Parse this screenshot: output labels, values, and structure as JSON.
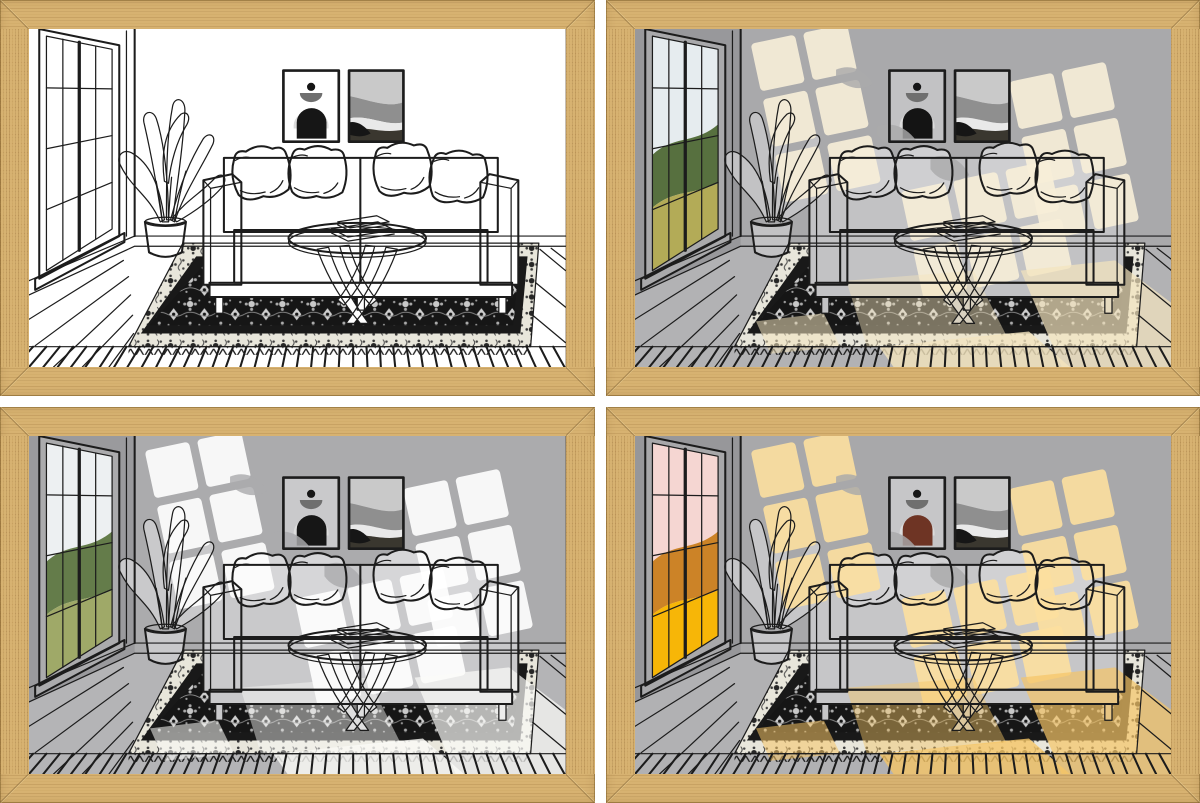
{
  "page": {
    "background": "#ffffff",
    "grid_gap_px": 11,
    "frame_border_px": 29
  },
  "frame_style": {
    "wood_base": "#d7b271",
    "wood_grain": "#926830",
    "wood_highlight": "#f0daa0",
    "wood_edge": "#80602c",
    "miter_corners": true
  },
  "scene": {
    "line_color": "#1c1c1c",
    "elements": [
      "window",
      "window-view",
      "potted-plant",
      "sofa",
      "throw-pillows",
      "wall-art-arch",
      "wall-art-waves",
      "coffee-table",
      "books",
      "oriental-rug",
      "rug-fringe",
      "wood-plank-floor",
      "baseboard",
      "sunlight-patches",
      "leaf-shadows"
    ],
    "art_arch": {
      "dot": "#161616",
      "half_disc": "#6f6f6f",
      "light_arch": "#dcdcdc"
    },
    "art_waves": {
      "colors": [
        "#c9c9c9",
        "#8f8f8f",
        "#e9e9e9",
        "#3a372f",
        "#161616"
      ]
    },
    "rug": {
      "field": "#161616",
      "motif_light": "#c9c9c9",
      "guard_band": "#191919",
      "border_bg": "#e8e6db",
      "border_motif": "#262626"
    }
  },
  "frames": [
    {
      "id": "top-left",
      "variant": "line-art-light-off",
      "lightOn": 0,
      "colors": {
        "wall": "#ffffff",
        "wallSide": "#ffffff",
        "floor": "#ffffff",
        "obj": "#ffffff",
        "pillow": "#ffffff",
        "artArch": "#161616",
        "viewSky": "#ffffff",
        "viewTrees": "#ffffff",
        "viewGround": "#ffffff",
        "light": "#ffffff",
        "pool": "#ffffff",
        "line": "#1c1c1c"
      }
    },
    {
      "id": "top-right",
      "variant": "warm-white-daylight",
      "lightOn": 1,
      "colors": {
        "wall": "#a9a9ab",
        "wallSide": "#98989b",
        "floor": "#b2b2b4",
        "obj": "#c2c2c4",
        "pillow": "#cfcfd1",
        "artArch": "#141414",
        "viewSky": "#e6ecef",
        "viewTrees": "#57703f",
        "viewGround": "#b3ab57",
        "light": "#f7eed8",
        "pool": "#f3e4bd",
        "line": "#1c1c1c"
      }
    },
    {
      "id": "bottom-left",
      "variant": "cool-white-daylight",
      "lightOn": 1,
      "colors": {
        "wall": "#ababad",
        "wallSide": "#9a9a9d",
        "floor": "#b4b4b6",
        "obj": "#c9c9cb",
        "pillow": "#d6d6d8",
        "artArch": "#161616",
        "viewSky": "#edf0f2",
        "viewTrees": "#647c4a",
        "viewGround": "#9fa968",
        "light": "#ffffff",
        "pool": "#fbfbf8",
        "line": "#1c1c1c"
      }
    },
    {
      "id": "bottom-right",
      "variant": "golden-hour",
      "lightOn": 1,
      "colors": {
        "wall": "#a8a8aa",
        "wallSide": "#97979a",
        "floor": "#b1b1b3",
        "obj": "#c6c6c8",
        "pillow": "#d1d1d3",
        "artArch": "#6e3424",
        "viewSky": "#f5d6d2",
        "viewTrees": "#cc8327",
        "viewGround": "#f7b607",
        "light": "#fcdf9f",
        "pool": "#f5c566",
        "line": "#1c1c1c"
      }
    }
  ]
}
